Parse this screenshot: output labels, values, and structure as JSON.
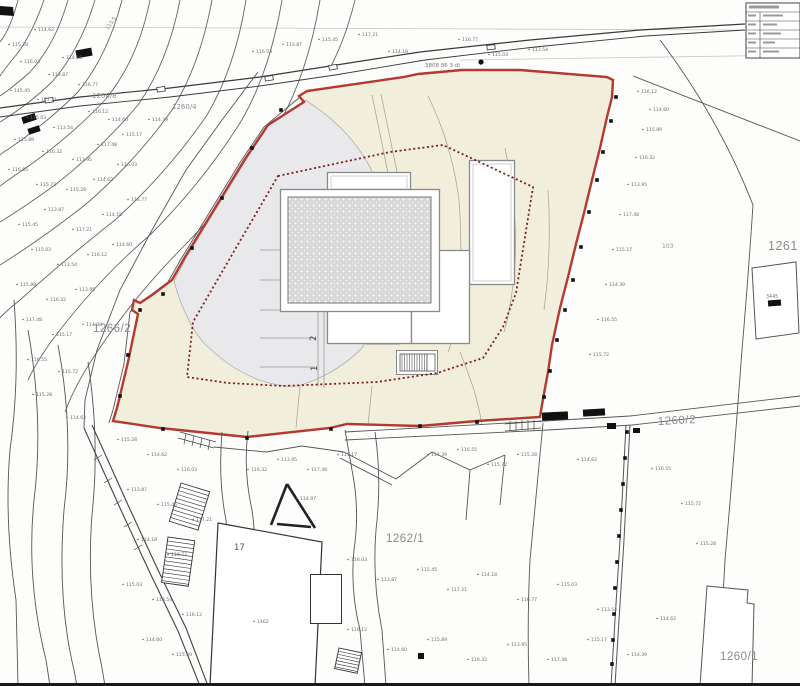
{
  "map": {
    "title": "cadastral-site-plan",
    "colors": {
      "boundary_red": "#b23a30",
      "building_line_red": "#7e1f15",
      "plot_fill": "#f1eedb",
      "paved_fill": "#e9e9ec",
      "hatch_fill": "#d8d8d8",
      "line_dark": "#3a3a3a",
      "label_gray": "#8a8a8a"
    },
    "labels": {
      "parcel_1266_2": "1266/2",
      "parcel_1262_1": "1262/1",
      "parcel_1260_2": "1260/2",
      "parcel_1261": "1261",
      "parcel_1260_1": "1260/1",
      "parcel_1266_8": "1266/8",
      "parcel_1260_4": "1260/4",
      "parcel_103": "103",
      "house_17": "17",
      "house_3445": "3445",
      "contour_113_5": "113.5",
      "road_note": "3808 86 3 dl",
      "spot_2": "2",
      "spot_1": "1"
    },
    "annotations": [
      [
        12,
        46,
        "115.28"
      ],
      [
        38,
        31,
        "114.62"
      ],
      [
        24,
        63,
        "116.03"
      ],
      [
        52,
        76,
        "113.87"
      ],
      [
        14,
        92,
        "115.45"
      ],
      [
        41,
        101,
        "117.21"
      ],
      [
        66,
        59,
        "114.18"
      ],
      [
        82,
        86,
        "116.77"
      ],
      [
        30,
        119,
        "115.03"
      ],
      [
        57,
        129,
        "113.54"
      ],
      [
        92,
        113,
        "116.12"
      ],
      [
        112,
        121,
        "114.60"
      ],
      [
        18,
        141,
        "115.89"
      ],
      [
        46,
        153,
        "116.32"
      ],
      [
        76,
        161,
        "113.95"
      ],
      [
        101,
        146,
        "117.48"
      ],
      [
        126,
        136,
        "115.17"
      ],
      [
        152,
        121,
        "114.39"
      ],
      [
        12,
        171,
        "116.55"
      ],
      [
        40,
        186,
        "115.72"
      ],
      [
        70,
        191,
        "115.28"
      ],
      [
        97,
        181,
        "114.62"
      ],
      [
        121,
        166,
        "116.03"
      ],
      [
        48,
        211,
        "113.87"
      ],
      [
        22,
        226,
        "115.45"
      ],
      [
        76,
        231,
        "117.21"
      ],
      [
        106,
        216,
        "114.18"
      ],
      [
        131,
        201,
        "116.77"
      ],
      [
        35,
        251,
        "115.03"
      ],
      [
        61,
        266,
        "113.54"
      ],
      [
        91,
        256,
        "116.12"
      ],
      [
        116,
        246,
        "114.60"
      ],
      [
        20,
        286,
        "115.89"
      ],
      [
        50,
        301,
        "116.32"
      ],
      [
        79,
        291,
        "113.95"
      ],
      [
        26,
        321,
        "117.48"
      ],
      [
        56,
        336,
        "115.17"
      ],
      [
        86,
        326,
        "114.39"
      ],
      [
        31,
        361,
        "116.55"
      ],
      [
        62,
        373,
        "115.72"
      ],
      [
        36,
        396,
        "115.28"
      ],
      [
        70,
        419,
        "114.62"
      ],
      [
        256,
        53,
        "116.03"
      ],
      [
        286,
        46,
        "113.87"
      ],
      [
        322,
        41,
        "115.45"
      ],
      [
        362,
        36,
        "117.21"
      ],
      [
        392,
        53,
        "114.18"
      ],
      [
        462,
        41,
        "116.77"
      ],
      [
        492,
        56,
        "115.03"
      ],
      [
        532,
        51,
        "113.54"
      ],
      [
        641,
        93,
        "116.12"
      ],
      [
        653,
        111,
        "114.60"
      ],
      [
        646,
        131,
        "115.89"
      ],
      [
        639,
        159,
        "116.32"
      ],
      [
        631,
        186,
        "113.95"
      ],
      [
        623,
        216,
        "117.48"
      ],
      [
        616,
        251,
        "115.17"
      ],
      [
        609,
        286,
        "114.39"
      ],
      [
        601,
        321,
        "116.55"
      ],
      [
        593,
        356,
        "115.72"
      ],
      [
        121,
        441,
        "115.28"
      ],
      [
        151,
        456,
        "114.62"
      ],
      [
        181,
        471,
        "116.03"
      ],
      [
        131,
        491,
        "113.87"
      ],
      [
        161,
        506,
        "115.45"
      ],
      [
        196,
        521,
        "117.21"
      ],
      [
        141,
        541,
        "114.18"
      ],
      [
        171,
        556,
        "116.77"
      ],
      [
        126,
        586,
        "115.03"
      ],
      [
        156,
        601,
        "113.54"
      ],
      [
        186,
        616,
        "116.12"
      ],
      [
        146,
        641,
        "114.60"
      ],
      [
        176,
        656,
        "115.89"
      ],
      [
        251,
        471,
        "116.32"
      ],
      [
        281,
        461,
        "113.95"
      ],
      [
        311,
        471,
        "117.48"
      ],
      [
        341,
        456,
        "115.17"
      ],
      [
        431,
        456,
        "114.39"
      ],
      [
        461,
        451,
        "116.55"
      ],
      [
        491,
        466,
        "115.72"
      ],
      [
        521,
        456,
        "115.28"
      ],
      [
        581,
        461,
        "114.62"
      ],
      [
        351,
        561,
        "116.03"
      ],
      [
        381,
        581,
        "113.87"
      ],
      [
        421,
        571,
        "115.45"
      ],
      [
        451,
        591,
        "117.21"
      ],
      [
        481,
        576,
        "114.18"
      ],
      [
        521,
        601,
        "116.77"
      ],
      [
        561,
        586,
        "115.03"
      ],
      [
        601,
        611,
        "113.54"
      ],
      [
        351,
        631,
        "116.12"
      ],
      [
        391,
        651,
        "114.60"
      ],
      [
        431,
        641,
        "115.89"
      ],
      [
        471,
        661,
        "116.32"
      ],
      [
        511,
        646,
        "113.95"
      ],
      [
        551,
        661,
        "117.48"
      ],
      [
        591,
        641,
        "115.17"
      ],
      [
        631,
        656,
        "114.39"
      ],
      [
        655,
        470,
        "116.55"
      ],
      [
        685,
        505,
        "115.72"
      ],
      [
        700,
        545,
        "115.28"
      ],
      [
        660,
        620,
        "114.62"
      ],
      [
        257,
        623,
        "1462"
      ],
      [
        300,
        500,
        "114.97"
      ]
    ],
    "survey_marks_right": [
      [
        616,
        97
      ],
      [
        611,
        121
      ],
      [
        603,
        152
      ],
      [
        597,
        180
      ],
      [
        589,
        212
      ],
      [
        581,
        247
      ],
      [
        573,
        280
      ],
      [
        565,
        310
      ],
      [
        557,
        340
      ],
      [
        550,
        371
      ],
      [
        544,
        397
      ]
    ],
    "boundary_marks_left": [
      [
        281,
        110
      ],
      [
        252,
        148
      ],
      [
        222,
        198
      ],
      [
        192,
        248
      ],
      [
        163,
        294
      ],
      [
        140,
        310
      ],
      [
        128,
        355
      ],
      [
        120,
        396
      ]
    ],
    "boundary_marks_bottom": [
      [
        163,
        429
      ],
      [
        247,
        438
      ],
      [
        331,
        429
      ],
      [
        420,
        426
      ],
      [
        477,
        422
      ]
    ],
    "fence_marks": [
      [
        627,
        432
      ],
      [
        625,
        458
      ],
      [
        623,
        484
      ],
      [
        621,
        510
      ],
      [
        619,
        536
      ],
      [
        617,
        562
      ],
      [
        615,
        588
      ],
      [
        614,
        614
      ],
      [
        613,
        640
      ],
      [
        612,
        664
      ]
    ],
    "black_buildings": [
      [
        542,
        412,
        26,
        8,
        -3
      ],
      [
        583,
        409,
        22,
        7,
        -3
      ],
      [
        607,
        423,
        9,
        6,
        0
      ],
      [
        633,
        428,
        7,
        5,
        0
      ],
      [
        76,
        49,
        16,
        8,
        -10
      ],
      [
        22,
        115,
        14,
        7,
        -18
      ],
      [
        28,
        127,
        12,
        6,
        -18
      ],
      [
        418,
        653,
        6,
        6,
        0
      ],
      [
        768,
        300,
        13,
        6,
        -4
      ]
    ]
  }
}
